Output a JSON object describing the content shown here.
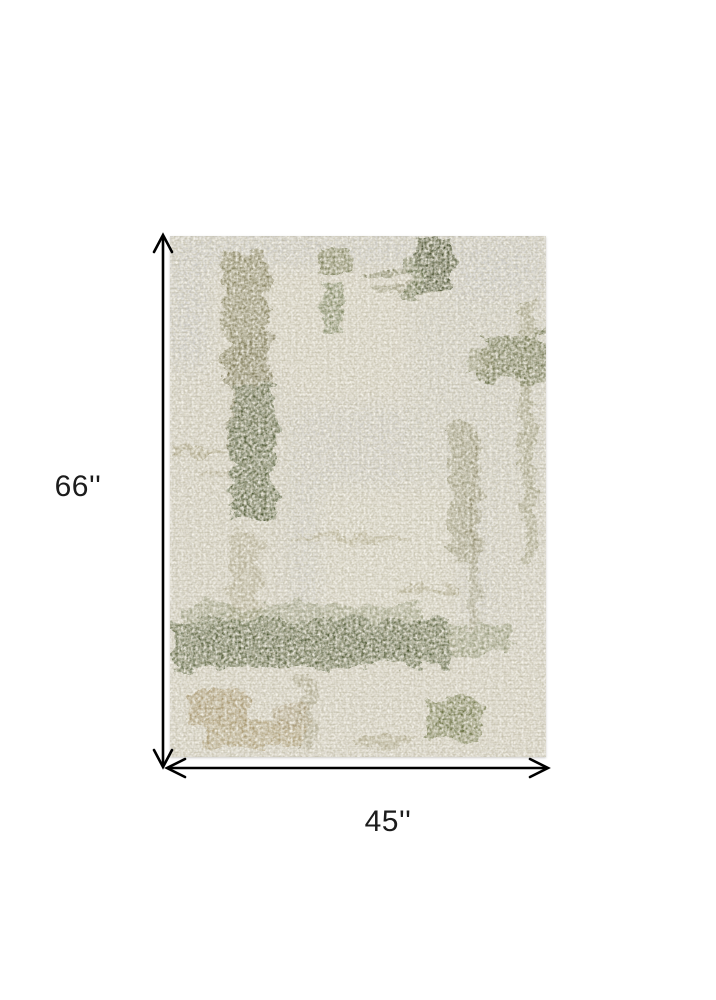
{
  "page": {
    "background_color": "#ffffff"
  },
  "product_image": {
    "description": "Abstract distressed area rug in ivory and gray with olive green brush strokes",
    "palette": {
      "rug-base": "#d6d3ca",
      "rug-gray": "#cbcbca",
      "rug-ivory": "#e9e5d8",
      "rug-olive-dark": "#46522d",
      "rug-olive": "#5a6136",
      "rug-olive-light": "#77744c",
      "rug-tan": "#9f8a5c"
    }
  },
  "dimensions": {
    "height_label": "66''",
    "width_label": "45''",
    "line_color": "#000000",
    "label_color": "#1c1c1c"
  }
}
